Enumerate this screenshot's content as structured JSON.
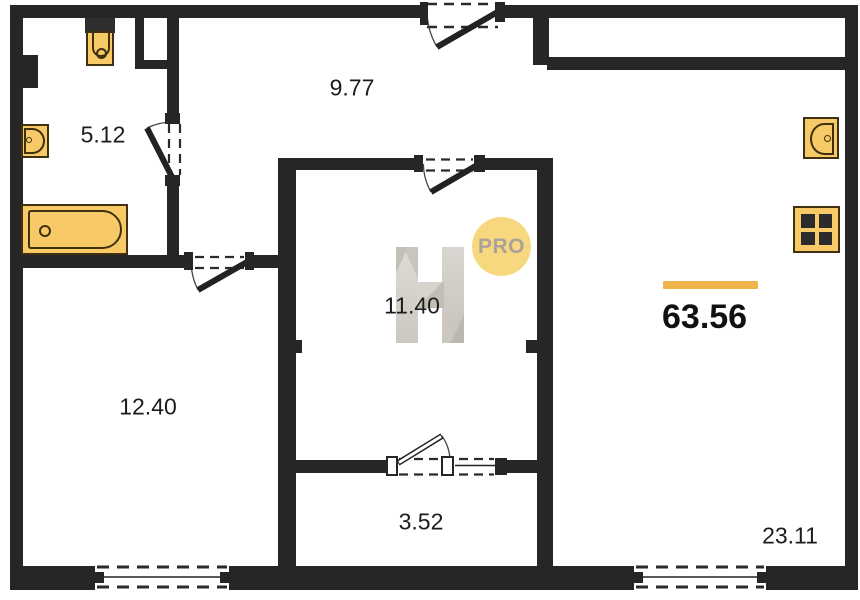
{
  "floor_plan": {
    "total_area": "63.56",
    "watermark": {
      "letter": "H",
      "badge": "PRO"
    },
    "rooms": {
      "bathroom": {
        "area": "5.12"
      },
      "hallway": {
        "area": "9.77"
      },
      "room_center": {
        "area": "11.40"
      },
      "room_left": {
        "area": "12.40"
      },
      "wardrobe": {
        "area": "3.52"
      },
      "living_kitchen": {
        "area": "23.11"
      }
    },
    "fixtures": [
      "toilet",
      "wash-basin",
      "bathtub",
      "kitchen-sink",
      "stove"
    ],
    "colors": {
      "wall": "#262626",
      "fixture_fill": "#f7ca67",
      "fixture_outline": "#3f3110",
      "accent_line": "#efb54c",
      "badge_fill": "#f8d87e",
      "badge_text": "#a8a29a",
      "label_text": "#1c1c1c"
    }
  }
}
